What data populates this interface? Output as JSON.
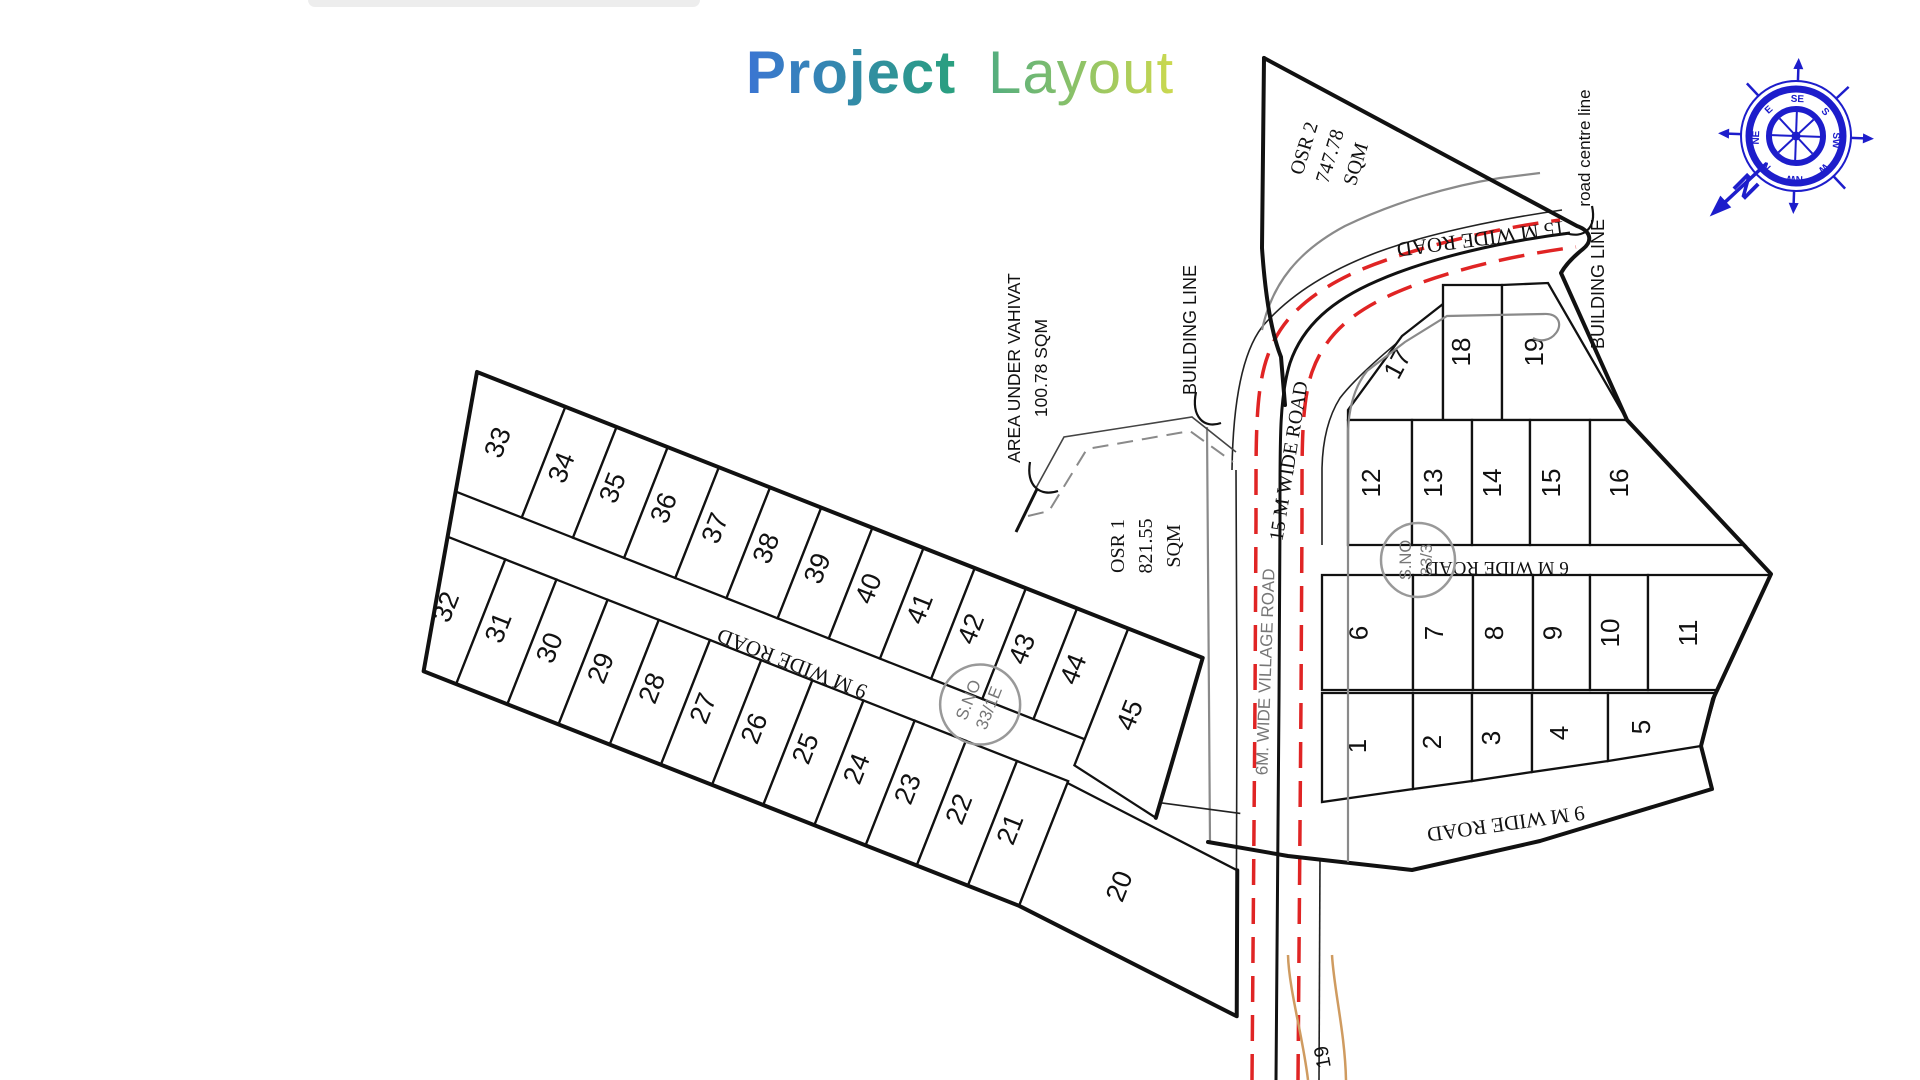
{
  "title": {
    "project": "Project",
    "layout": "Layout"
  },
  "compass": {
    "directions": [
      "N",
      "NE",
      "E",
      "SE",
      "S",
      "SW",
      "W",
      "NW"
    ],
    "north_arrow": "N",
    "color": "#1d1dcb"
  },
  "left_block": {
    "top_row": [
      "33",
      "34",
      "35",
      "36",
      "37",
      "38",
      "39",
      "40",
      "41",
      "42",
      "43",
      "44",
      "45"
    ],
    "bottom_row": [
      "32",
      "31",
      "30",
      "29",
      "28",
      "27",
      "26",
      "25",
      "24",
      "23",
      "22",
      "21",
      "20"
    ],
    "road_label": "9 M WIDE ROAD",
    "survey": {
      "line1": "S.NO",
      "line2": "33/1E"
    }
  },
  "right_block": {
    "top_row": [
      "17",
      "18",
      "19"
    ],
    "mid_row": [
      "12",
      "13",
      "14",
      "15",
      "16"
    ],
    "low_row": [
      "6",
      "7",
      "8",
      "9",
      "10",
      "11"
    ],
    "bottom_row": [
      "1",
      "2",
      "3",
      "4",
      "5"
    ],
    "road_6m": "6 M WIDE ROAD",
    "road_9m": "9 M WIDE ROAD",
    "survey": {
      "line1": "S.NO",
      "line2": "33/3"
    }
  },
  "roads": {
    "wide15_top": "15 M WIDE ROAD",
    "wide15_side": "15 M WIDE ROAD",
    "village": "6M. WIDE VILLAGE ROAD",
    "bottom_marker": "19"
  },
  "annotations": {
    "osr1": [
      "OSR 1",
      "821.55",
      "SQM"
    ],
    "osr2": [
      "OSR 2",
      "747.78",
      "SQM"
    ],
    "vahivat": [
      "AREA UNDER VAHIVAT",
      "100.78 SQM"
    ],
    "building_line_left": "BUILDING LINE",
    "building_line_right": "BUILDING LINE",
    "road_centre": "road centre line"
  },
  "colors": {
    "compass": "#1d1dcb",
    "road_red": "#e02424",
    "road_gray": "#8a8a8a",
    "village_road": "#cf9b60",
    "ink": "#111111"
  }
}
